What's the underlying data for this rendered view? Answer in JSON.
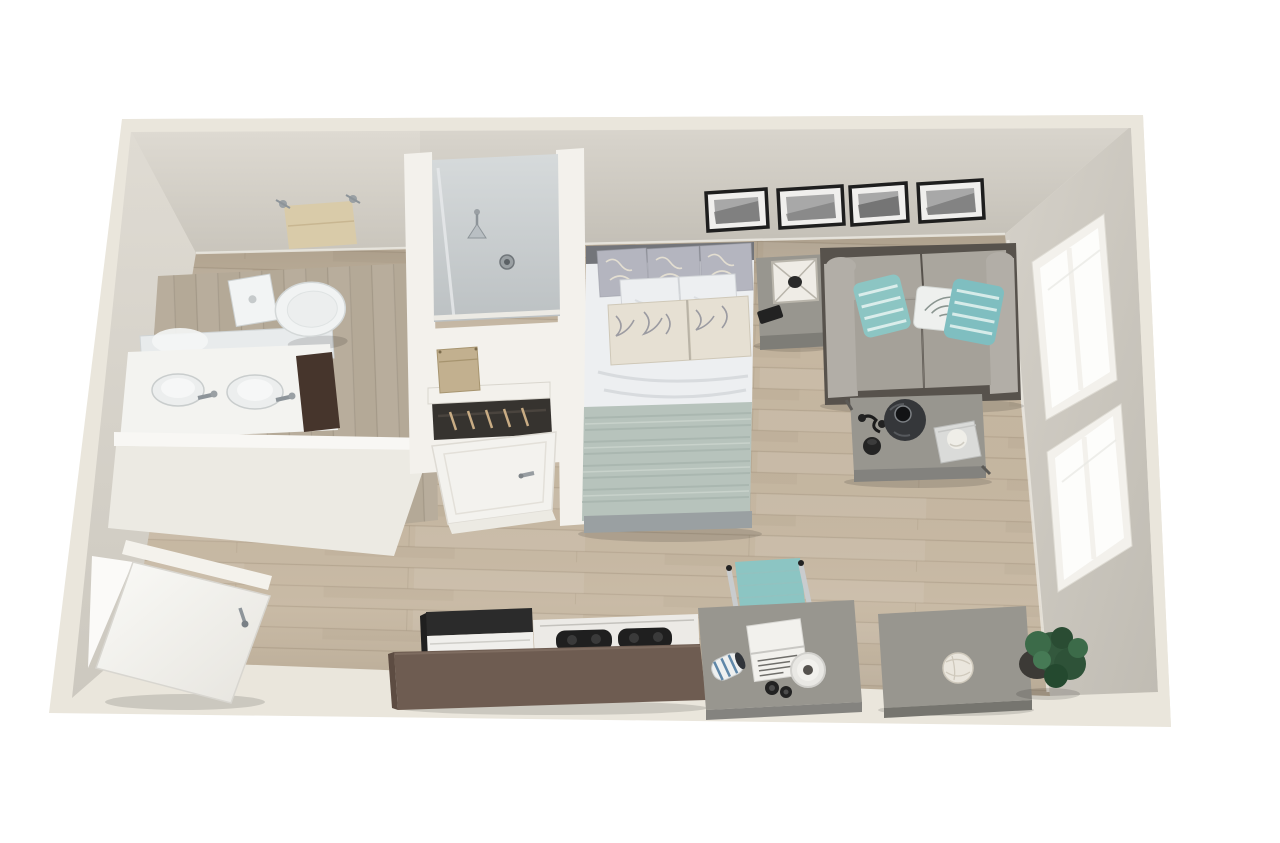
{
  "page": {
    "description": "3D top-down cutaway rendering of a studio apartment floor plan, no text labels",
    "view": "isometric cutaway from above",
    "background": "#ffffff"
  },
  "palette": {
    "wall_cream": "#eae6dc",
    "wall_face": "#cdc9c0",
    "wall_face_light": "#d8d4cb",
    "floor_wood": "#c6b7a1",
    "bathroom_floor": "#b4a997",
    "white_trim": "#f3f1ec",
    "counter_brown": "#6e5c51",
    "sofa_frame": "#57524c",
    "sofa_cushion": "#aaa69e",
    "accent_teal": "#8cc5c3",
    "blanket_sage": "#b7c3bc",
    "duvet_white": "#edeff1",
    "furniture_gray": "#98968f",
    "headboard_gray": "#73757a",
    "cabinet_brown": "#46352c",
    "towel_tan": "#d9cba9",
    "shower_glass": "#c9ced1",
    "plant_green": "#33583d",
    "frame_black": "#1e1e1e",
    "photo_gray": "#a8a8a8",
    "door_white": "#f7f6f3"
  },
  "rooms": [
    {
      "name": "bathroom",
      "furniture": [
        "towel-rack with tan towel",
        "toilet",
        "vanity with sink and faucet",
        "mirror with reflection",
        "dark wood vanity cabinet"
      ]
    },
    {
      "name": "shower-stall",
      "furniture": [
        "shower head",
        "floor drain",
        "glass enclosure"
      ]
    },
    {
      "name": "closet-nook",
      "furniture": [
        "shelf with storage box",
        "hanging rod with hangers",
        "closed interior door"
      ]
    },
    {
      "name": "sleeping-area",
      "furniture": [
        "queen bed with white duvet and sage blanket",
        "3 patterned back pillows",
        "2 white pillows",
        "2 patterned accent pillows",
        "gray headboard",
        "nightstand with lantern and phone"
      ]
    },
    {
      "name": "living-area",
      "furniture": [
        "gray loveseat",
        "2 teal striped pillows",
        "1 white botanical pillow",
        "coffee table with dark vase, black decor and book with sphere",
        "gallery wall of 4 black-framed photos"
      ]
    },
    {
      "name": "kitchen",
      "furniture": [
        "refrigerator with black top",
        "white cooktop range with black burners",
        "brown island counter"
      ]
    },
    {
      "name": "work-area",
      "furniture": [
        "gray desk",
        "teal task chair with chrome arms",
        "open laptop",
        "striped mug",
        "white bowl",
        "camera"
      ]
    },
    {
      "name": "storage-corner",
      "furniture": [
        "gray dresser with white rope ball",
        "potted green plant"
      ]
    },
    {
      "name": "entry",
      "furniture": [
        "open white entry door with chrome handle"
      ]
    },
    {
      "name": "east-wall",
      "furniture": [
        "two white double-pane windows"
      ]
    }
  ]
}
